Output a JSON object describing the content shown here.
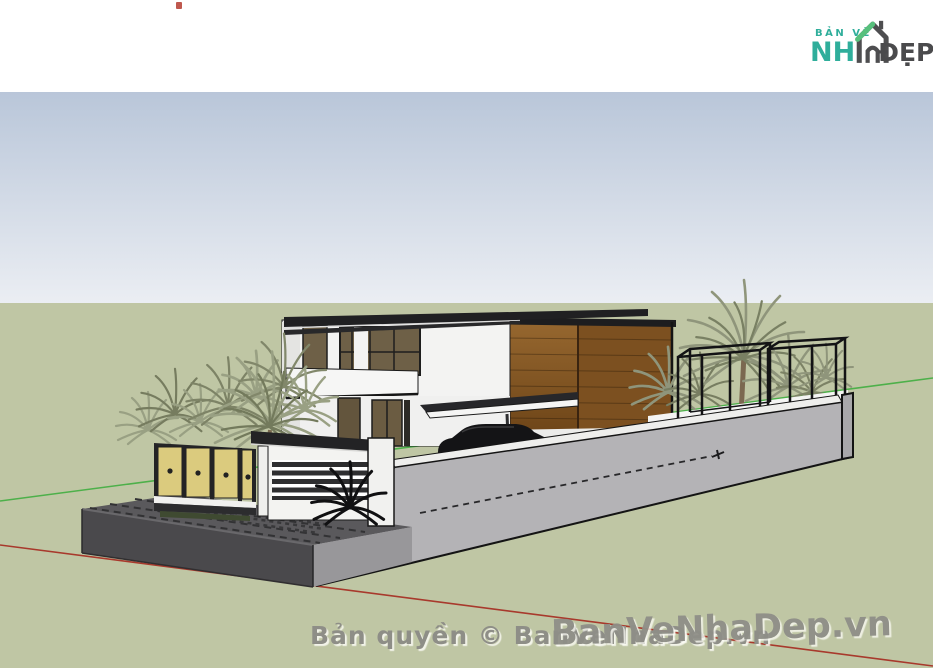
{
  "header": {
    "logo": {
      "top_text": "BẢN VẼ",
      "main_text": "NH",
      "suffix_text": "ĐẸP",
      "icon_name": "house-logo"
    }
  },
  "watermarks": {
    "copyright_text": "Bản quyền © BanVeNhaDep.vn",
    "diagonal_text": "BanVeNhaDep.vn"
  },
  "colors": {
    "logo_teal": "#2fae9b",
    "logo_green": "#57c07c",
    "logo_dark": "#4a4a4c",
    "sky_top": "#b9c6d9",
    "sky_bottom": "#ebeef3",
    "grass": "#bfc6a4",
    "axis_red": "#a8392c",
    "axis_green": "#4db04a",
    "roof_dark": "#202022",
    "wood_light": "#8a5a26",
    "wood_dark": "#7c5020",
    "wall_gray": "#b4b3b6",
    "platform_dark": "#4a494c",
    "platform_side": "#98979a",
    "fence_tan": "#dbcb7e",
    "palm_green": "#99a083",
    "watermark_gray": "#8e8e87"
  }
}
